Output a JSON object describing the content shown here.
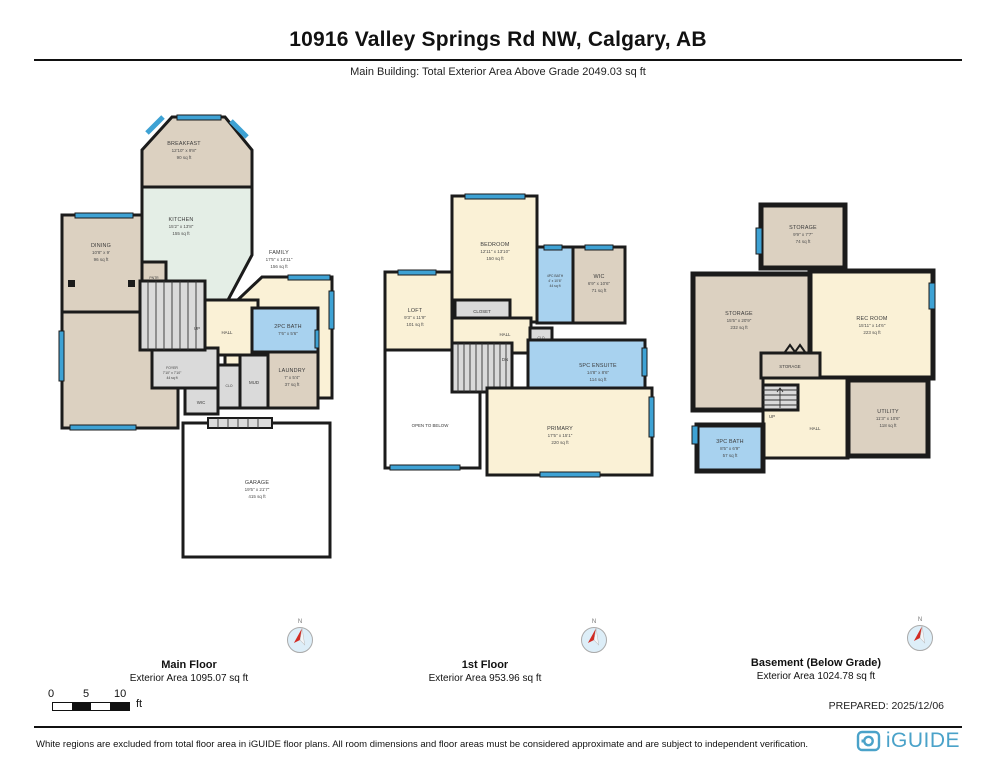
{
  "header": {
    "title": "10916 Valley Springs Rd NW, Calgary, AB",
    "subtitle": "Main Building: Total Exterior Area Above Grade 2049.03 sq ft"
  },
  "colors": {
    "wall": "#1b1b1b",
    "window_blue": "#3ea2d4",
    "bathroom_blue": "#a8d2ef",
    "room_tan": "#dcd1c1",
    "room_cream": "#faf1d6",
    "kitchen_mint": "#e4eee6",
    "logo_blue": "#4aa2c9",
    "compass_red": "#d22b23"
  },
  "floors": {
    "main": {
      "name": "Main Floor",
      "area": "Exterior Area 1095.07 sq ft",
      "rooms": {
        "breakfast": {
          "label": "BREAKFAST",
          "dims": "12'10\" x 9'8\"",
          "area": "90 sq ft"
        },
        "kitchen": {
          "label": "KITCHEN",
          "dims": "15'2\" x 13'8\"",
          "area": "155 sq ft"
        },
        "dining": {
          "label": "DINING",
          "dims": "10'8\" x 9'",
          "area": "96 sq ft"
        },
        "family": {
          "label": "FAMILY",
          "dims": "17'5\" x 14'11\"",
          "area": "156 sq ft"
        },
        "living": {
          "label": "LIVING",
          "dims": "10'11\" x 16'1\"",
          "area": "162 sq ft"
        },
        "foyer": {
          "label": "FOYER",
          "dims": "7'10\" x 7'10\"",
          "area": "44 sq ft"
        },
        "bath2pc": {
          "label": "2PC BATH",
          "dims": "7'6\" x 5'6\""
        },
        "laundry": {
          "label": "LAUNDRY",
          "dims": "7' x 5'4\"",
          "area": "37 sq ft"
        },
        "garage": {
          "label": "GARAGE",
          "dims": "19'5\" x 21'7\"",
          "area": "415 sq ft"
        },
        "hall": {
          "label": "HALL"
        },
        "up": {
          "label": "UP"
        },
        "wic": {
          "label": "WIC"
        },
        "clo": {
          "label": "CLO"
        },
        "mud": {
          "label": "MUD"
        },
        "pntr": {
          "label": "PNTR"
        }
      }
    },
    "second": {
      "name": "1st Floor",
      "area": "Exterior Area 953.96 sq ft",
      "rooms": {
        "bedroom": {
          "label": "BEDROOM",
          "dims": "12'11\" x 13'10\"",
          "area": "150 sq ft"
        },
        "loft": {
          "label": "LOFT",
          "dims": "9'3\" x 11'9\"",
          "area": "101 sq ft"
        },
        "bath4pc": {
          "label": "4PC BATH",
          "dims": "4' x 10'6\"",
          "area": "44 sq ft"
        },
        "wic": {
          "label": "WIC",
          "dims": "6'9\" x 10'6\"",
          "area": "71 sq ft"
        },
        "ensuite": {
          "label": "5PC ENSUITE",
          "dims": "14'8\" x 8'6\"",
          "area": "114 sq ft"
        },
        "primary": {
          "label": "PRIMARY",
          "dims": "17'5\" x 15'1\"",
          "area": "220 sq ft"
        },
        "closet": {
          "label": "CLOSET"
        },
        "clo": {
          "label": "CLO"
        },
        "hall": {
          "label": "HALL"
        },
        "dn": {
          "label": "DN"
        },
        "open": {
          "label": "OPEN TO BELOW"
        }
      }
    },
    "basement": {
      "name": "Basement (Below Grade)",
      "area": "Exterior Area 1024.78 sq ft",
      "rooms": {
        "storage1": {
          "label": "STORAGE",
          "dims": "9'9\" x 7'7\"",
          "area": "74 sq ft"
        },
        "storage2": {
          "label": "STORAGE",
          "dims": "15'5\" x 20'9\"",
          "area": "232 sq ft"
        },
        "rec": {
          "label": "REC ROOM",
          "dims": "15'11\" x 14'6\"",
          "area": "223 sq ft"
        },
        "utility": {
          "label": "UTILITY",
          "dims": "11'3\" x 10'6\"",
          "area": "118 sq ft"
        },
        "bath3pc": {
          "label": "3PC BATH",
          "dims": "8'5\" x 6'9\"",
          "area": "57 sq ft"
        },
        "storage3": {
          "label": "STORAGE"
        },
        "hall": {
          "label": "HALL"
        },
        "up": {
          "label": "UP"
        }
      }
    }
  },
  "footer": {
    "compass": "N",
    "scale": {
      "t0": "0",
      "t5": "5",
      "t10": "10",
      "unit": "ft"
    },
    "prepared": "PREPARED: 2025/12/06",
    "disclaimer": "White regions are excluded from total floor area in iGUIDE floor plans. All room dimensions and floor areas must be considered approximate and are subject to independent verification."
  },
  "logo": {
    "text": "iGUIDE"
  }
}
